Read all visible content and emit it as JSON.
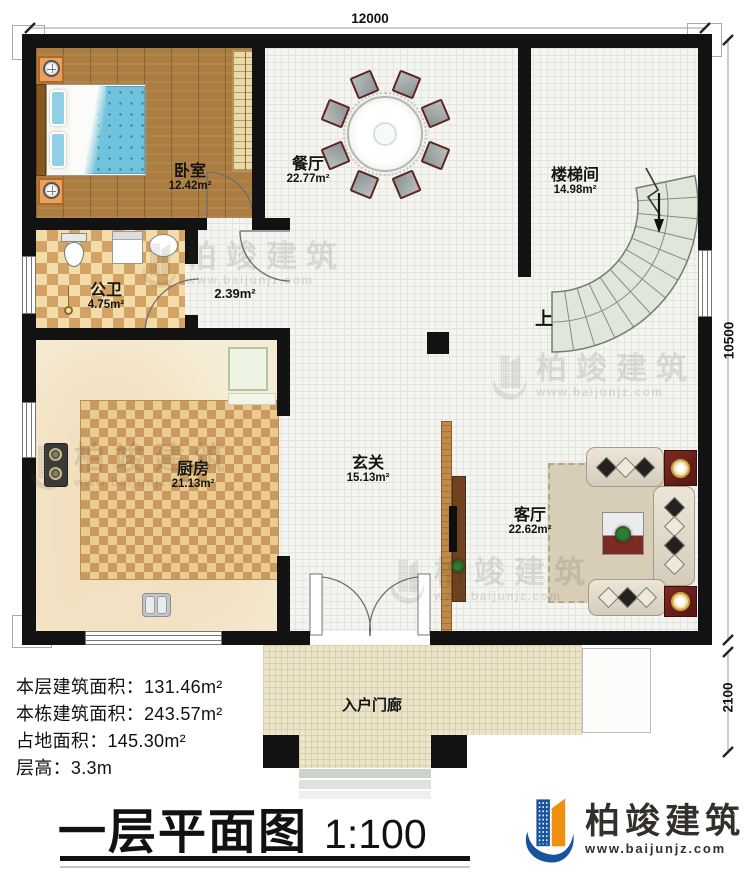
{
  "dimensions": {
    "width_top": "12000",
    "height_right": "10500",
    "porch_depth": "2100"
  },
  "rooms": {
    "bedroom": {
      "name": "卧室",
      "area": "12.42m²"
    },
    "dining": {
      "name": "餐厅",
      "area": "22.77m²"
    },
    "stairwell": {
      "name": "楼梯间",
      "area": "14.98m²"
    },
    "bathroom": {
      "name": "公卫",
      "area": "4.75m²"
    },
    "closet": {
      "area": "2.39m²"
    },
    "kitchen": {
      "name": "厨房",
      "area": "21.13m²"
    },
    "foyer": {
      "name": "玄关",
      "area": "15.13m²"
    },
    "living": {
      "name": "客厅",
      "area": "22.62m²"
    },
    "porch": {
      "name": "入户门廊"
    }
  },
  "stairs": {
    "up_label": "上"
  },
  "info": [
    {
      "label": "本层建筑面积：",
      "value": "131.46m²"
    },
    {
      "label": "本栋建筑面积：",
      "value": "243.57m²"
    },
    {
      "label": "占地面积：",
      "value": "145.30m²"
    },
    {
      "label": "层高：",
      "value": "3.3m"
    }
  ],
  "title": {
    "text": "一层平面图",
    "scale": "1:100"
  },
  "brand": {
    "name": "柏竣建筑",
    "url": "www.baijunjz.com",
    "blue": "#17549b",
    "orange": "#f0900f"
  },
  "watermark": {
    "name": "柏竣建筑",
    "url": "www.baijunjz.com"
  }
}
